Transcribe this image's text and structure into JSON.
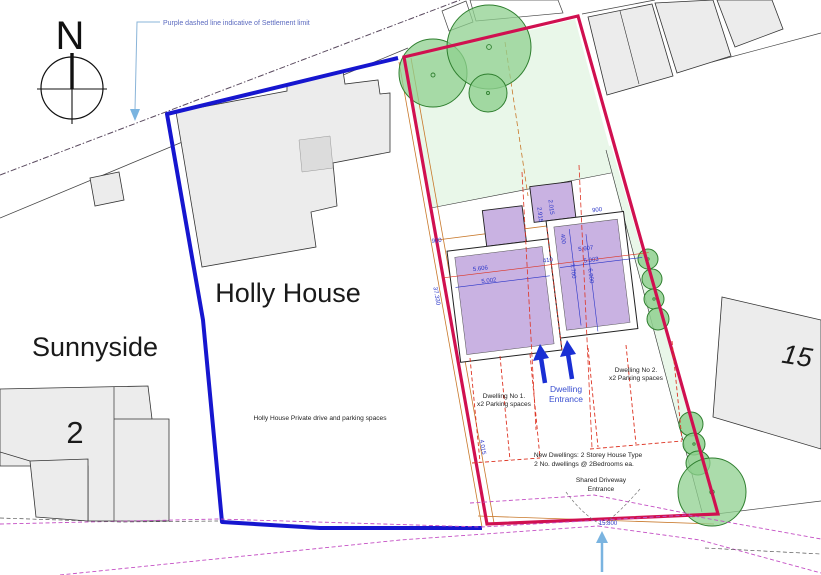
{
  "annotation": {
    "settlement_note": "Purple dashed line indicative of Settlement limit"
  },
  "compass": {
    "north_label": "N"
  },
  "labels": {
    "holly_house": "Holly House",
    "sunnyside": "Sunnyside",
    "house_no_2": "2",
    "house_no_15": "15"
  },
  "notes": {
    "private_drive": "Holly House Private drive and parking spaces",
    "dwelling1_line1": "Dwelling No 1.",
    "dwelling1_line2": "x2 Parking spaces",
    "dwelling2_line1": "Dwelling No 2.",
    "dwelling2_line2": "x2 Parking spaces",
    "entrance_line1": "Dwelling",
    "entrance_line2": "Entrance",
    "new_dwellings_line1": "New Dwellings: 2 Storey House Type",
    "new_dwellings_line2": "2 No. dwellings @ 2Bedrooms ea.",
    "shared_drive_line1": "Shared Driveway",
    "shared_drive_line2": "Entrance"
  },
  "dimensions": {
    "left_dwelling_width": "5.606",
    "left_dwelling_inner": "5.002",
    "party_wall": "410",
    "right_dwelling_width": "5.607",
    "right_dwelling_inner": "5.003",
    "right_dwelling_depth": "7.700",
    "right_dwelling_depth_inner": "6.900",
    "porch_left": "2.915",
    "porch_right": "2.015",
    "porch_offset": "400",
    "offset_left": "900",
    "offset_right": "900",
    "boundary_length": "37.330",
    "drive_width": "4.015",
    "frontage": "15.800"
  },
  "colors": {
    "red_boundary": "#d01050",
    "blue_boundary": "#1616cf",
    "dwelling_fill": "#c9b2e2",
    "tree_fill": "#8fd08f",
    "tree_stroke": "#2f7f2f",
    "garden_fill": "#e9f7e9",
    "dimension_text": "#2a35c8",
    "settlement_line": "#5a4a5f",
    "magenta_dashed": "#c44fc4",
    "orange_line": "#c8782a",
    "red_dashed": "#dd3322",
    "leader_arrow": "#7ab4e0",
    "building_fill": "#ececec"
  }
}
